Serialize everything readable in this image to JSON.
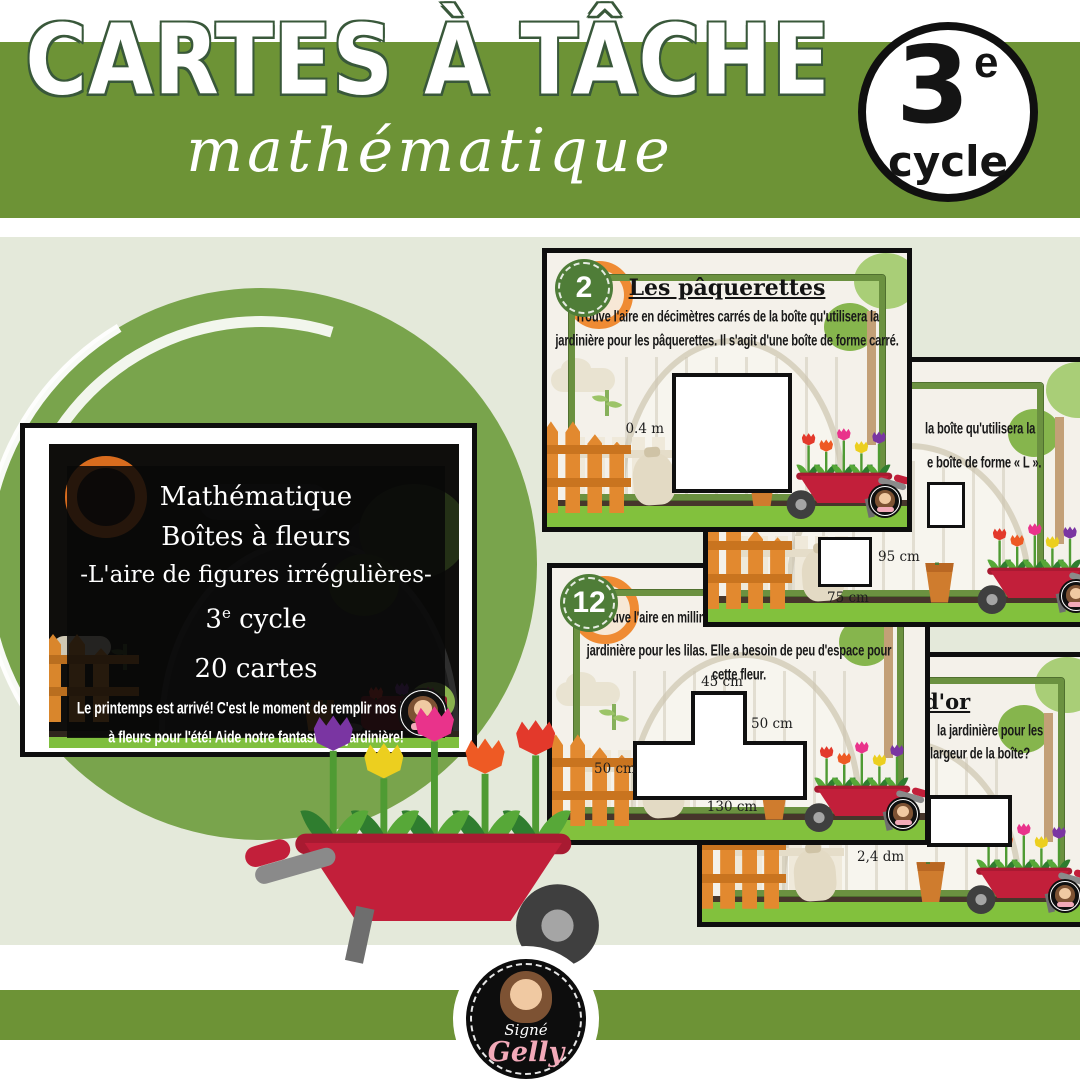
{
  "header": {
    "title": "CARTES À TÂCHE",
    "subtitle": "mathématique",
    "badge": {
      "number": "3",
      "ordinal": "e",
      "word": "cycle"
    }
  },
  "cover": {
    "line1": "Mathématique",
    "line2": "Boîtes à fleurs",
    "line3": "-L'aire de figures irrégulières-",
    "cycle_number": "3",
    "cycle_ordinal": "e",
    "cycle_word": " cycle",
    "line5": "20 cartes",
    "caption1": "Le printemps est arrivé! C'est le moment de remplir nos boîtes",
    "caption2": "à fleurs pour l'été! Aide notre fantastique jardinière!"
  },
  "card_paquerettes": {
    "number": "2",
    "title": "Les pâquerettes",
    "line1": "Trouve l'aire en décimètres carrés de la boîte qu'utilisera la",
    "line2": "jardinière pour les pâquerettes. Il s'agit d'une boîte de forme carré.",
    "side_label": "0.4 m"
  },
  "card_forme_L": {
    "fragment1": "la boîte qu'utilisera la",
    "fragment2": "e boîte de forme « L ».",
    "label_right": "95 cm",
    "label_bottom": "75 cm"
  },
  "card_lilas": {
    "number": "12",
    "line1": "Trouve l'aire en millimèt",
    "line2": "jardinière pour les lilas. Elle a besoin de peu d'espace pour",
    "line3": "cette fleur.",
    "label_top": "45 cm",
    "label_right": "50 cm",
    "label_left": "50 cm",
    "label_bottom": "130 cm"
  },
  "card_or": {
    "title_fragment": "d'or",
    "fragment1": "la jardinière pour les",
    "fragment2": "largeur de la boîte?",
    "label": "2,4 dm"
  },
  "logo": {
    "line1": "Signé",
    "line2": "Gelly"
  },
  "colors": {
    "band_green": "#6d9336",
    "brush_green": "#79a44c",
    "frame_green": "#6b9140",
    "badge_green": "#4f7d38",
    "page_bg": "#e4e9da",
    "scene_bg": "#f4f1ea",
    "wheelbarrow_red": "#c21f3a",
    "logo_pink": "#f2a9b8"
  }
}
